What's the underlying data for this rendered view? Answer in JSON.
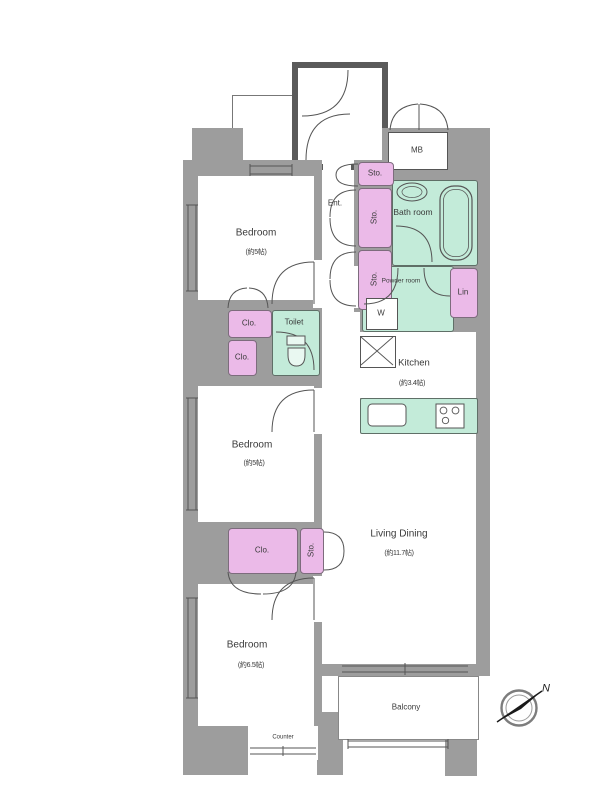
{
  "floorplan": {
    "bedroom1": {
      "name": "Bedroom",
      "area": "(約5帖)"
    },
    "bedroom2": {
      "name": "Bedroom",
      "area": "(約5帖)"
    },
    "bedroom3": {
      "name": "Bedroom",
      "area": "(約6.5帖)"
    },
    "living_dining": {
      "name": "Living Dining",
      "area": "(約11.7帖)"
    },
    "kitchen": {
      "name": "Kitchen",
      "area": "(約3.4帖)"
    },
    "bathroom": {
      "name": "Bath room"
    },
    "powder_room": {
      "name": "Powder room"
    },
    "toilet": {
      "name": "Toilet"
    },
    "entrance": {
      "name": "Ent."
    },
    "meter_box": {
      "name": "MB"
    },
    "balcony": {
      "name": "Balcony"
    },
    "counter": {
      "name": "Counter"
    },
    "linen": {
      "name": "Lin"
    },
    "washer": {
      "name": "W"
    },
    "storage": {
      "sto1": "Sto.",
      "sto2": "Sto.",
      "sto3": "Sto.",
      "sto4": "Sto."
    },
    "closets": {
      "clo1": "Clo.",
      "clo2": "Clo.",
      "clo3": "Clo."
    },
    "compass": {
      "north": "N"
    },
    "colors": {
      "wall": "#9d9d9d",
      "closet_fill": "#ebbae8",
      "wet_fill": "#c3ebd9",
      "outline": "#555555"
    }
  }
}
